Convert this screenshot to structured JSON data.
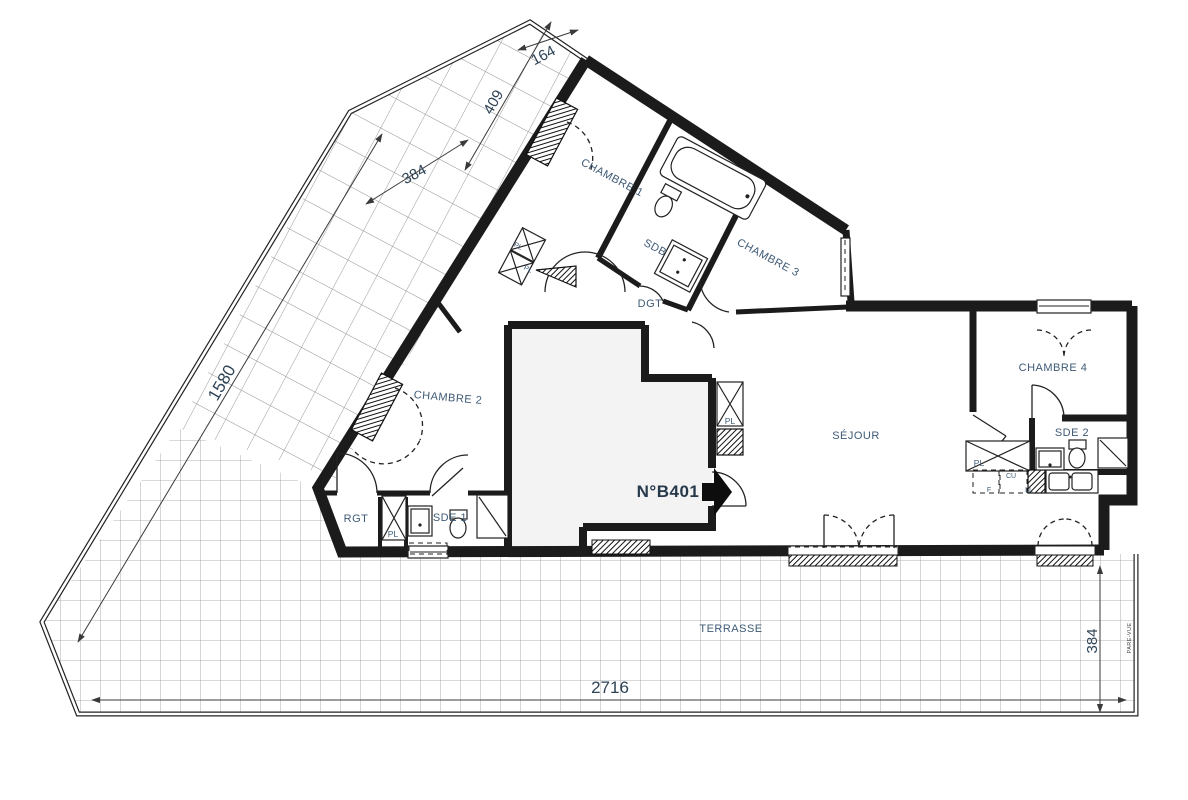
{
  "plan": {
    "unit_label": "N°B401",
    "rooms": {
      "chambre1": "CHAMBRE 1",
      "sdb": "SDB",
      "chambre3": "CHAMBRE 3",
      "dgt": "DGT",
      "chambre2": "CHAMBRE 2",
      "sejour": "SÉJOUR",
      "chambre4": "CHAMBRE 4",
      "sde2": "SDE 2",
      "sde1": "SDE 1",
      "rgt": "RGT",
      "terrasse": "TERRASSE"
    },
    "closets": {
      "wing_pl_a": "PL",
      "wing_pl_b": "PL",
      "rgt_pl": "PL",
      "palier_pl": "PL",
      "kitchen_pl": "PL"
    },
    "kitchen": {
      "cu": "CU",
      "f": "F",
      "ll": "LL"
    },
    "dimensions": {
      "d164": "164",
      "d409": "409",
      "d384_top": "384",
      "d1580": "1580",
      "d2716": "2716",
      "d384_right": "384"
    },
    "annotations": {
      "pare_vue": "PARE-VUE"
    },
    "colors": {
      "wall": "#1b1b1b",
      "room_label": "#3e5a76",
      "dimension_label": "#2e4356",
      "grid_line": "#999999",
      "landing_fill": "#f3f3f3"
    }
  }
}
